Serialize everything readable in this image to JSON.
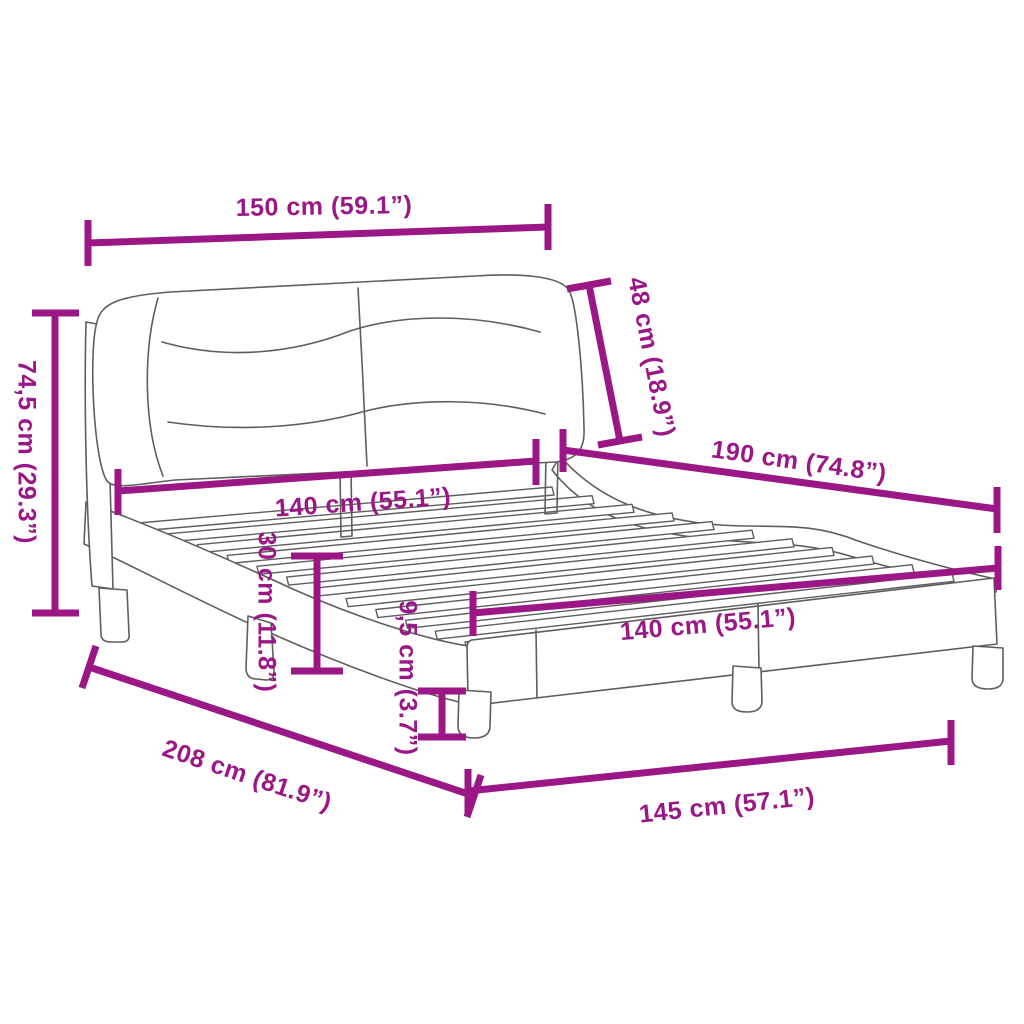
{
  "diagram": {
    "accent_color": "#9B1786",
    "drawing_color": "#5E5E5E",
    "background_color": "#FFFFFF",
    "subject": "bed-frame-with-headboard-dimension-diagram",
    "dimensions": {
      "top_width": "150 cm (59.1”)",
      "total_height": "74,5 cm (29.3”)",
      "headboard_cushion_height": "48 cm (18.9”)",
      "inner_length": "190 cm (74.8”)",
      "headboard_inner_width": "140 cm (55.1”)",
      "rail_height": "30 cm (11.8”)",
      "leg_height": "9,5 cm (3.7”)",
      "foot_inner_width": "140 cm (55.1”)",
      "total_length": "208 cm (81.9”)",
      "foot_outer_width": "145 cm (57.1”)"
    }
  }
}
